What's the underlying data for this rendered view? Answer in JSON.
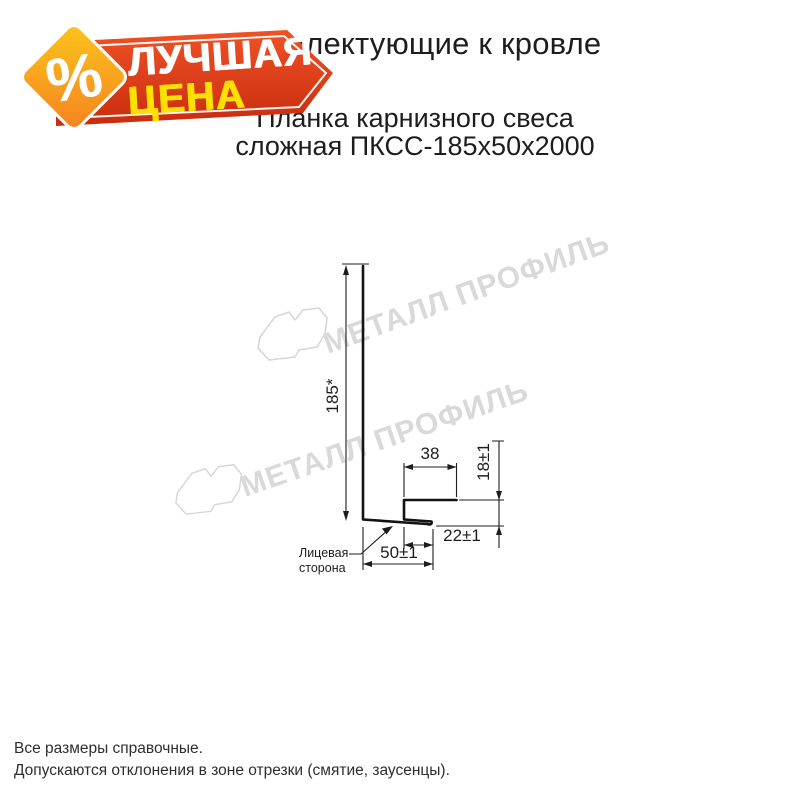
{
  "badge": {
    "line1": "ЛУЧШАЯ",
    "line2": "ЦЕНА",
    "percent": "%",
    "colors": {
      "red_top": "#ef5226",
      "red_bottom": "#c92c0e",
      "diamond_top": "#fcc51d",
      "diamond_bottom": "#f58220",
      "text_yellow": "#ffe000",
      "text_white": "#ffffff"
    }
  },
  "header": {
    "title": "Комплектующие к кровле",
    "subtitle_line1": "Планка карнизного свеса",
    "subtitle_line2": "сложная ПКСС-185х50х2000"
  },
  "drawing": {
    "dim_height": "185*",
    "dim_hook_top": "38",
    "dim_hook_height": "18±1",
    "dim_tip": "22±1",
    "dim_bottom": "50±1",
    "face_label_line1": "Лицевая",
    "face_label_line2": "сторона",
    "line_color": "#131313"
  },
  "watermark": {
    "text": "МЕТАЛЛ ПРОФИЛЬ",
    "color": "#d9d9d9"
  },
  "footer": {
    "line1": "Все размеры справочные.",
    "line2": "Допускаются отклонения в зоне отрезки (смятие, заусенцы)."
  }
}
